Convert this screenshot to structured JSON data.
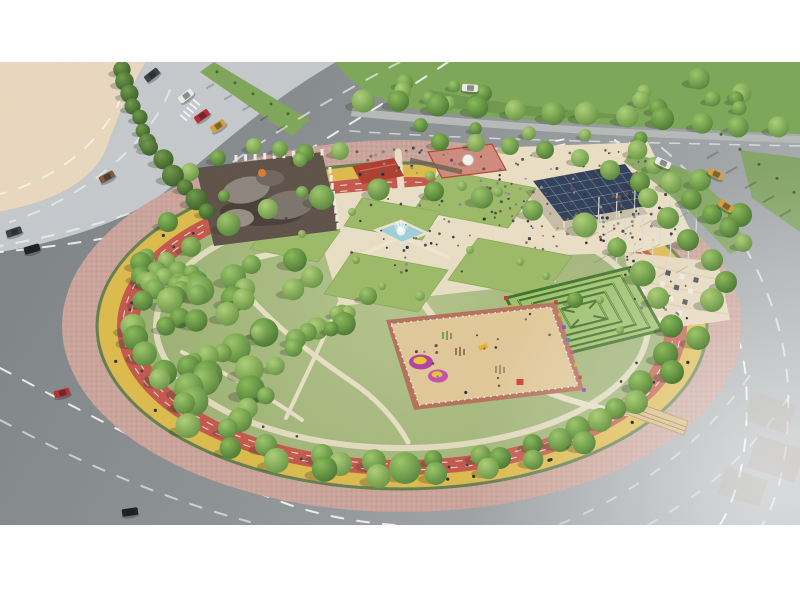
{
  "meta": {
    "kind": "aerial-render-circular-park",
    "canvas_w": 800,
    "canvas_h": 600,
    "letterbox_top": 62,
    "letterbox_bottom": 525
  },
  "colors": {
    "white": "#ffffff",
    "sand": "#ead9bf",
    "concrete": "#c6cacd",
    "sidewalk": "#b7bab9",
    "grass": "#7ca757",
    "grass_dark": "#5d8a3f",
    "park_green": "#a4b87c",
    "lawn": "#9cba68",
    "lawn_edge": "#8aa957",
    "brick": "#cba49a",
    "brick_dot": "#b68d82",
    "bike_yellow": "#ddba4a",
    "track_red": "#c4574a",
    "hedge": "#4d7a36",
    "cream": "#e9dfc5",
    "cream_bright": "#efe6cf",
    "pool": "#9ed0d8",
    "fountain_white": "#f4f2ec",
    "maze_base": "#9ec06b",
    "maze_wall": "#3f7028",
    "maze_wall_light": "#9ed06a",
    "play_sand": "#e2c898",
    "play_border": "#b5705a",
    "canopy": "#2f3e57",
    "canopy_grid": "#8fa2bd",
    "shade_ground": "#5d5047",
    "blob1": "#8d857c",
    "blob2": "#7c746b",
    "blob3": "#968e85",
    "blob4": "#6e665e",
    "roof_red": "#ad3d2c",
    "plaza_pink": "#d08a7c",
    "terrace": "#e6d8ba",
    "bridge": "#d9b97a",
    "building_ghost": "#d8cdbb"
  },
  "car_colors": {
    "dark": "#3a3f46",
    "black": "#1b1e22",
    "white": "#edece6",
    "red": "#b52d32",
    "yellow": "#d2a13b",
    "brown": "#7a5a40"
  },
  "people_palette": [
    "#3e3e4a",
    "#6b5747",
    "#2f2f38",
    "#7d6c58",
    "#8a8a92",
    "#5a4a5e"
  ],
  "shapes": {
    "sand_d": "M0,62 L146,62 C128,92 116,122 106,150 C92,180 60,200 0,212 Z",
    "concrete_d": "M146,62 L336,62 C270,100 215,150 165,192 C125,222 60,242 0,252 L0,212 C60,200 92,180 106,150 C116,122 128,92 146,62 Z",
    "green_top_d": "M335,62 L800,62 L800,134 C640,128 480,118 418,110 C382,104 352,86 335,62 Z",
    "sidewalk_d": "M352,108 C480,122 640,131 800,136 L800,143 C640,138 480,129 351,116 Z",
    "median_pts": "200,72 214,62 310,120 292,136",
    "rightverge_pts": "740,150 800,158 800,232 752,198",
    "wedge_pts": "630,152 688,170 724,202 748,246 730,254 694,216 654,182 624,162",
    "crowd_pts": "436,150 648,142 694,238 640,252 540,256 470,234 436,188",
    "fplaza_pts": "308,196 512,178 556,282 340,306",
    "terrace_pts": "624,252 718,262 730,320 640,332",
    "lawn1_pts": "442,170 536,188 508,228 414,210",
    "lawn2_pts": "478,238 572,256 542,298 448,280",
    "lawn3_pts": "352,252 448,270 418,312 324,294",
    "lawn4_pts": "362,198 440,212 422,240 344,226",
    "lawn5_pts": "272,218 340,231 318,262 250,249",
    "shade_pts": "196,168 322,152 340,230 214,246",
    "canopy_pts": "533,181 625,164 656,204 564,221",
    "canopy_shadow_pts": "525,191 617,174 648,214 556,231",
    "playground_pts": "386,320 556,302 584,390 414,410",
    "playground_inner_pts": "391,324 551,307 578,386 419,405",
    "pool_pts": "376,230 401,221 427,233 402,243",
    "bridge_pts": "620,412 624,398 688,421 684,435",
    "buildingA_pts": "352,166 394,158 404,176 362,184",
    "plazaPink_pts": "428,152 492,144 506,170 442,178"
  },
  "scene": {
    "trees_singles": [
      [
        405,
        468,
        16
      ],
      [
        440,
        142,
        9
      ],
      [
        476,
        143,
        9
      ],
      [
        510,
        146,
        9
      ],
      [
        545,
        150,
        9
      ],
      [
        580,
        158,
        9
      ],
      [
        610,
        170,
        10
      ],
      [
        640,
        182,
        10
      ],
      [
        648,
        198,
        10
      ],
      [
        668,
        218,
        11
      ],
      [
        688,
        240,
        11
      ],
      [
        254,
        146,
        8
      ],
      [
        280,
        149,
        8
      ],
      [
        305,
        153,
        9
      ],
      [
        340,
        151,
        9
      ],
      [
        368,
        296,
        9
      ],
      [
        575,
        300,
        8
      ],
      [
        600,
        420,
        12
      ],
      [
        560,
        440,
        12
      ],
      [
        500,
        458,
        11
      ],
      [
        340,
        464,
        12
      ],
      [
        240,
        420,
        12
      ],
      [
        168,
        222,
        10
      ],
      [
        150,
        282,
        10
      ],
      [
        700,
        180,
        11
      ],
      [
        740,
        215,
        12
      ],
      [
        712,
        300,
        12
      ],
      [
        698,
        338,
        12
      ],
      [
        672,
        372,
        12
      ],
      [
        636,
        402,
        12
      ],
      [
        300,
        160,
        7
      ],
      [
        218,
        158,
        8
      ],
      [
        190,
        172,
        9
      ],
      [
        712,
        260,
        11
      ],
      [
        726,
        282,
        11
      ]
    ],
    "tree_clusters": [
      {
        "type": "ring",
        "cx": 402,
        "cy": 326,
        "rx": 266,
        "ry": 136,
        "count": 30,
        "rmin": 9,
        "rmax": 13,
        "jitter": 10,
        "seed": 41
      },
      {
        "type": "ring",
        "cx": 402,
        "cy": 326,
        "rx": 288,
        "ry": 150,
        "count": 9,
        "rmin": 10,
        "rmax": 13,
        "jitter": 6,
        "seed": 43,
        "t0": 0.9,
        "t1": 2.4
      },
      {
        "type": "blob",
        "cx": 218,
        "cy": 338,
        "rx": 102,
        "ry": 78,
        "count": 40,
        "rmin": 8,
        "rmax": 15,
        "seed": 47
      },
      {
        "type": "blob",
        "cx": 300,
        "cy": 298,
        "rx": 58,
        "ry": 42,
        "count": 10,
        "rmin": 7,
        "rmax": 12,
        "seed": 53
      },
      {
        "type": "blob",
        "cx": 162,
        "cy": 262,
        "rx": 28,
        "ry": 38,
        "count": 7,
        "rmin": 8,
        "rmax": 12,
        "seed": 59
      },
      {
        "type": "row",
        "a": [
          363,
          100
        ],
        "b": [
          777,
          128
        ],
        "count": 12,
        "rmin": 9,
        "rmax": 12,
        "wobble": 5,
        "seed": 61
      },
      {
        "type": "row",
        "a": [
          120,
          70
        ],
        "b": [
          148,
          142
        ],
        "count": 7,
        "rmin": 7,
        "rmax": 10,
        "wobble": 4,
        "seed": 67,
        "shade": "dark"
      },
      {
        "type": "row",
        "a": [
          150,
          148
        ],
        "b": [
          208,
          212
        ],
        "count": 6,
        "rmin": 8,
        "rmax": 12,
        "wobble": 4,
        "seed": 68,
        "shade": "dark"
      },
      {
        "type": "row",
        "a": [
          636,
          152
        ],
        "b": [
          746,
          246
        ],
        "count": 7,
        "rmin": 8,
        "rmax": 11,
        "wobble": 6,
        "seed": 71
      },
      {
        "type": "blob",
        "cx": 700,
        "cy": 103,
        "rx": 68,
        "ry": 26,
        "count": 9,
        "rmin": 7,
        "rmax": 11,
        "seed": 73
      },
      {
        "type": "blob",
        "cx": 430,
        "cy": 90,
        "rx": 55,
        "ry": 16,
        "count": 6,
        "rmin": 6,
        "rmax": 9,
        "seed": 79
      },
      {
        "type": "row",
        "a": [
          420,
          126
        ],
        "b": [
          640,
          138
        ],
        "count": 5,
        "rmin": 6,
        "rmax": 8,
        "wobble": 3,
        "seed": 83
      }
    ],
    "shrubs": [
      [
        430,
        176,
        5
      ],
      [
        462,
        186,
        5
      ],
      [
        498,
        192,
        5
      ],
      [
        352,
        212,
        4
      ],
      [
        302,
        234,
        4
      ],
      [
        420,
        296,
        5
      ],
      [
        382,
        286,
        4
      ],
      [
        520,
        262,
        4
      ],
      [
        546,
        276,
        4
      ],
      [
        470,
        250,
        4
      ],
      [
        356,
        260,
        4
      ],
      [
        600,
        300,
        4
      ],
      [
        620,
        330,
        4
      ]
    ],
    "palms": [
      [
        214,
        84,
        5.5
      ],
      [
        232,
        95,
        5.5
      ],
      [
        250,
        106,
        5.5
      ],
      [
        268,
        116,
        5.5
      ],
      [
        285,
        126,
        5.5
      ],
      [
        718,
        152,
        8
      ],
      [
        737,
        167,
        8
      ],
      [
        756,
        182,
        8
      ],
      [
        774,
        196,
        8
      ],
      [
        791,
        210,
        8
      ]
    ],
    "cars": [
      [
        152,
        75,
        -38,
        "dark"
      ],
      [
        186,
        96,
        -38,
        "white"
      ],
      [
        202,
        116,
        -35,
        "red"
      ],
      [
        218,
        126,
        -33,
        "yellow"
      ],
      [
        107,
        177,
        -28,
        "brown"
      ],
      [
        14,
        232,
        -18,
        "dark"
      ],
      [
        32,
        249,
        -16,
        "black"
      ],
      [
        470,
        88,
        4,
        "white"
      ],
      [
        663,
        163,
        24,
        "white"
      ],
      [
        716,
        174,
        27,
        "yellow"
      ],
      [
        62,
        393,
        -14,
        "red"
      ],
      [
        130,
        512,
        -8,
        "black"
      ],
      [
        726,
        206,
        32,
        "yellow"
      ]
    ],
    "crowds": [
      {
        "name": "main-crowd",
        "quad": [
          [
            448,
            158
          ],
          [
            640,
            148
          ],
          [
            688,
            235
          ],
          [
            520,
            252
          ]
        ],
        "count": 150,
        "seed": 7
      },
      {
        "name": "plaza-walkers",
        "quad": [
          [
            330,
            200
          ],
          [
            480,
            192
          ],
          [
            505,
            270
          ],
          [
            340,
            282
          ]
        ],
        "count": 32,
        "seed": 11
      },
      {
        "name": "terrace-crowd",
        "quad": [
          [
            624,
            256
          ],
          [
            712,
            266
          ],
          [
            700,
            322
          ],
          [
            620,
            310
          ]
        ],
        "count": 22,
        "seed": 13
      },
      {
        "name": "entrance-crowd",
        "quad": [
          [
            350,
            150
          ],
          [
            450,
            145
          ],
          [
            460,
            175
          ],
          [
            360,
            182
          ]
        ],
        "count": 25,
        "seed": 17
      },
      {
        "name": "playground-kids",
        "quad": [
          [
            410,
            330
          ],
          [
            545,
            312
          ],
          [
            565,
            382
          ],
          [
            430,
            400
          ]
        ],
        "count": 16,
        "seed": 19
      }
    ],
    "track_people": [
      {
        "name": "runners",
        "cx": 402,
        "cy": 326,
        "rx": 274,
        "ry": 143,
        "t0": 0.2,
        "t1": 3.9,
        "count": 18,
        "seed": 23,
        "size": 1.6,
        "color": "#3a3a40"
      },
      {
        "name": "cyclists",
        "cx": 402,
        "cy": 326,
        "rx": 294,
        "ry": 155,
        "t0": 0.1,
        "t1": 3.9,
        "count": 15,
        "seed": 29,
        "size": 1.8,
        "color": "#2e2e34"
      },
      {
        "name": "path-walkers",
        "cx": 402,
        "cy": 326,
        "rx": 246,
        "ry": 122,
        "t0": 0,
        "t1": 6.28,
        "count": 12,
        "seed": 31,
        "size": 1.5,
        "color": "#4a4438"
      }
    ],
    "poles": [
      [
        598,
        232
      ],
      [
        616,
        228
      ],
      [
        634,
        224
      ],
      [
        652,
        220
      ],
      [
        670,
        216
      ],
      [
        688,
        212
      ],
      [
        606,
        256
      ],
      [
        624,
        252
      ],
      [
        642,
        248
      ],
      [
        660,
        244
      ],
      [
        678,
        240
      ],
      [
        696,
        236
      ],
      [
        616,
        282
      ],
      [
        634,
        278
      ],
      [
        652,
        274
      ],
      [
        670,
        270
      ],
      [
        688,
        266
      ]
    ],
    "checker": {
      "x": 640,
      "y": 266,
      "ux": 14,
      "uy": 3.5,
      "vx": -5.5,
      "vy": 11,
      "cols": 5,
      "rows": 5,
      "size": 5,
      "dark": "#3a3a40",
      "light": "#efece1"
    },
    "colonnades": [
      {
        "a": [
          236,
          158
        ],
        "b": [
          322,
          152
        ],
        "n": 10
      },
      {
        "a": [
          330,
          170
        ],
        "b": [
          338,
          226
        ],
        "n": 8
      }
    ],
    "maze": {
      "pts": [
        [
          506,
          298
        ],
        [
          628,
          268
        ],
        [
          662,
          330
        ],
        [
          540,
          360
        ]
      ],
      "insets": [
        0.16,
        0.34,
        0.52,
        0.7
      ],
      "dots": [
        "#c33b30",
        "#d9a82e",
        "#7b3fc2",
        "#2f86c2",
        "#c33b87",
        "#d9a82e",
        "#c33b30",
        "#7b3fc2"
      ]
    },
    "playground_equipment": [
      {
        "t": "mound",
        "x": 421,
        "y": 362,
        "rx": 12,
        "ry": 7.5,
        "c": "#b43fa0",
        "c2": "#e8c832"
      },
      {
        "t": "mound",
        "x": 438,
        "y": 376,
        "rx": 10,
        "ry": 6.5,
        "c": "#c44fb0",
        "c2": "#edc52e"
      },
      {
        "t": "box",
        "x": 520,
        "y": 382,
        "w": 7,
        "h": 6,
        "c": "#cc3b33",
        "rot": 0
      },
      {
        "t": "box",
        "x": 483,
        "y": 347,
        "w": 9,
        "h": 5,
        "c": "#e8b02a",
        "rot": -20
      },
      {
        "t": "frame",
        "x": 447,
        "y": 336,
        "c": "#5a8a46"
      },
      {
        "t": "frame",
        "x": 500,
        "y": 370,
        "c": "#8a7a62"
      },
      {
        "t": "frame",
        "x": 460,
        "y": 352,
        "c": "#7a5a40"
      }
    ],
    "fence_dots": [
      "#c33b30",
      "#d9a82e",
      "#7b3fc2",
      "#2f86c2",
      "#c33b87",
      "#d9a82e",
      "#c33b30",
      "#7b3fc2"
    ],
    "crosswalks": [
      {
        "x": 190,
        "y": 110,
        "rot": -50,
        "n": 5
      },
      {
        "x": 562,
        "y": 150,
        "rot": 78,
        "n": 5
      }
    ],
    "ghost_buildings_top": [
      [
        425,
        68,
        55,
        28,
        0.5
      ],
      [
        492,
        64,
        60,
        32,
        0.45
      ],
      [
        565,
        62,
        70,
        34,
        0.5
      ],
      [
        648,
        62,
        75,
        38,
        0.45
      ],
      [
        733,
        62,
        64,
        42,
        0.55
      ]
    ],
    "ghost_buildings_right": [
      [
        738,
        396,
        46,
        30,
        0.3
      ],
      [
        756,
        436,
        50,
        34,
        0.3
      ],
      [
        736,
        476,
        44,
        28,
        0.28
      ]
    ]
  }
}
